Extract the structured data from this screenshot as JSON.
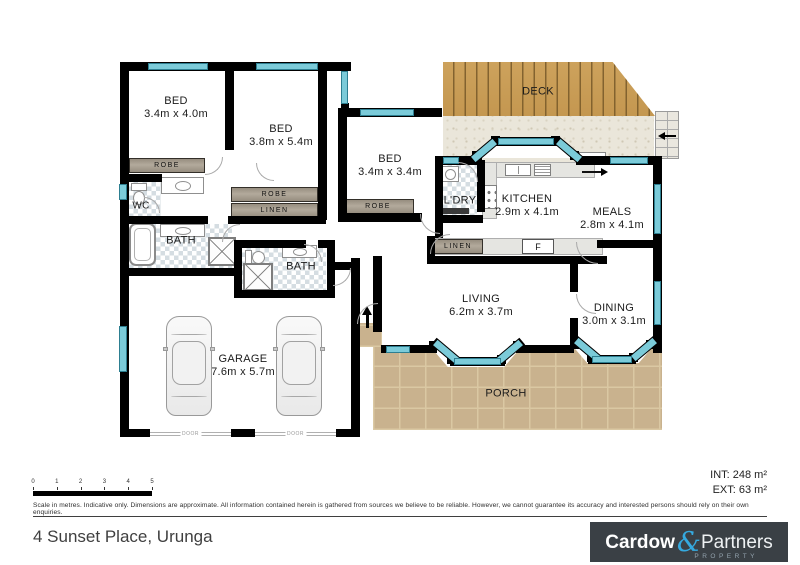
{
  "rooms": {
    "bed1": {
      "name": "BED",
      "dims": "3.4m x 4.0m"
    },
    "bed2": {
      "name": "BED",
      "dims": "3.8m x 5.4m"
    },
    "bed3": {
      "name": "BED",
      "dims": "3.4m x 3.4m"
    },
    "wc": {
      "name": "WC"
    },
    "bath1": {
      "name": "BATH"
    },
    "bath2": {
      "name": "BATH"
    },
    "garage": {
      "name": "GARAGE",
      "dims": "7.6m x 5.7m"
    },
    "laundry": {
      "name": "L'DRY"
    },
    "kitchen": {
      "name": "KITCHEN",
      "dims": "2.9m x 4.1m"
    },
    "meals": {
      "name": "MEALS",
      "dims": "2.8m x 4.1m"
    },
    "living": {
      "name": "LIVING",
      "dims": "6.2m x 3.7m"
    },
    "dining": {
      "name": "DINING",
      "dims": "3.0m x 3.1m"
    },
    "deck": {
      "name": "DECK"
    },
    "porch": {
      "name": "PORCH"
    }
  },
  "labels": {
    "robe": "ROBE",
    "linen": "LINEN",
    "fridge": "F",
    "door": "DOOR"
  },
  "scale": {
    "ticks": [
      "0",
      "1",
      "2",
      "3",
      "4",
      "5"
    ],
    "caption": "Scale in metres. Indicative only. Dimensions are approximate. All information contained herein is gathered from sources we believe to be reliable. However, we cannot guarantee its accuracy and interested persons should rely on their own enquiries."
  },
  "areas": {
    "internal": "INT: 248 m²",
    "external": "EXT: 63 m²"
  },
  "footer": {
    "address": "4 Sunset Place, Urunga",
    "logo": {
      "word1": "Cardow",
      "amp": "&",
      "word2": "Partners",
      "tagline": "PROPERTY"
    }
  },
  "colors": {
    "wall": "#000000",
    "window": "#7bcbd9",
    "deck_wood": "#c89a4e",
    "porch_paver": "#c8b28c",
    "logo_bg": "#3a4045",
    "logo_accent": "#35aae0"
  }
}
